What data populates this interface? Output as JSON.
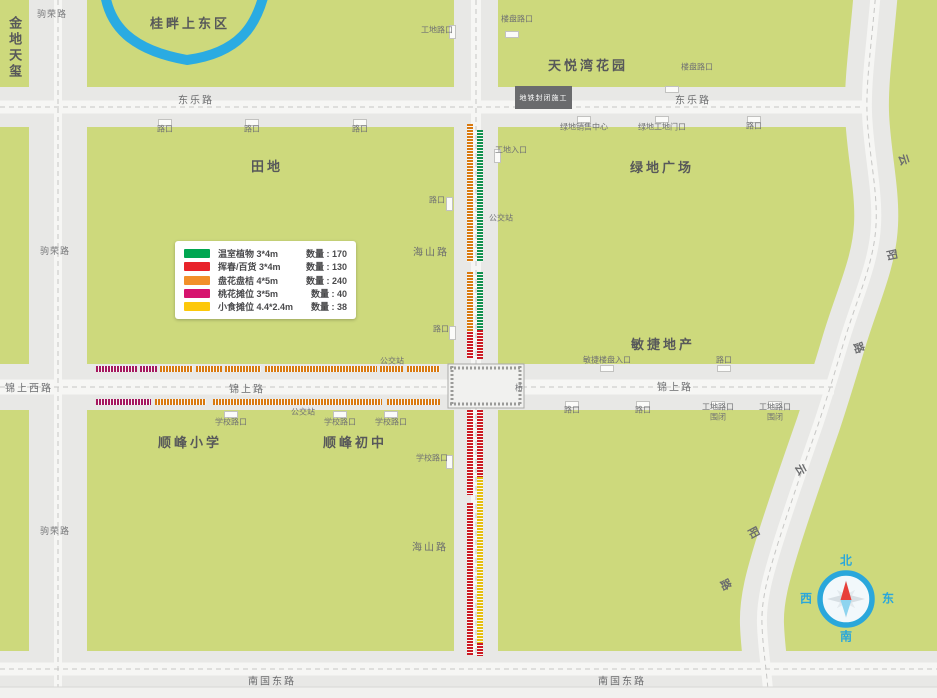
{
  "legend": {
    "rows": [
      {
        "color": "#00a651",
        "name": "温室植物 3*4m",
        "count": "数量 : 170"
      },
      {
        "color": "#e8232a",
        "name": "挥春/百货 3*4m",
        "count": "数量 : 130"
      },
      {
        "color": "#f2902a",
        "name": "盘花盘桔 4*5m",
        "count": "数量 : 240"
      },
      {
        "color": "#d6136e",
        "name": "桃花摊位 3*5m",
        "count": "数量 : 40"
      },
      {
        "color": "#fdc80a",
        "name": "小食摊位 4.4*2.4m",
        "count": "数量 : 38"
      }
    ]
  },
  "compass": {
    "north": "北",
    "south": "南",
    "east": "东",
    "west": "西"
  },
  "construction_sign": "地铁封闭施工",
  "colors": {
    "block_green": "#cdd97c",
    "road_gray": "#e8e8e6",
    "road_core": "#f6f6f4",
    "water_blue": "#2aabe2",
    "compass_blue": "#2aa7db",
    "stall_orange": "#d9790f",
    "stall_red": "#cc1b24",
    "stall_green": "#13914f",
    "stall_magenta": "#a5185f",
    "stall_yellow": "#e6bf0e"
  },
  "map": {
    "area_labels": [
      {
        "text": "金地天玺",
        "x": 14,
        "y": 48,
        "cls": "lbl-area lbl-vert"
      },
      {
        "text": "桂畔上东区",
        "x": 190,
        "y": 24,
        "cls": "lbl-area"
      },
      {
        "text": "天悦湾花园",
        "x": 588,
        "y": 66,
        "cls": "lbl-area"
      },
      {
        "text": "田地",
        "x": 267,
        "y": 167,
        "cls": "lbl-area"
      },
      {
        "text": "绿地广场",
        "x": 662,
        "y": 168,
        "cls": "lbl-area"
      },
      {
        "text": "敏捷地产",
        "x": 663,
        "y": 345,
        "cls": "lbl-area"
      },
      {
        "text": "顺峰小学",
        "x": 190,
        "y": 443,
        "cls": "lbl-area"
      },
      {
        "text": "顺峰初中",
        "x": 355,
        "y": 443,
        "cls": "lbl-area"
      }
    ],
    "road_labels": [
      {
        "text": "驹荣路",
        "x": 52,
        "y": 15,
        "cls": "lbl-road-sm"
      },
      {
        "text": "东乐路",
        "x": 196,
        "y": 101,
        "cls": "lbl-road"
      },
      {
        "text": "东乐路",
        "x": 693,
        "y": 101,
        "cls": "lbl-road"
      },
      {
        "text": "驹荣路",
        "x": 55,
        "y": 252,
        "cls": "lbl-road-sm"
      },
      {
        "text": "海山路",
        "x": 431,
        "y": 253,
        "cls": "lbl-road"
      },
      {
        "text": "锦上西路",
        "x": 29,
        "y": 389,
        "cls": "lbl-road"
      },
      {
        "text": "锦上路",
        "x": 247,
        "y": 390,
        "cls": "lbl-road"
      },
      {
        "text": "锦上路",
        "x": 675,
        "y": 388,
        "cls": "lbl-road"
      },
      {
        "text": "驹荣路",
        "x": 55,
        "y": 532,
        "cls": "lbl-road-sm"
      },
      {
        "text": "海山路",
        "x": 430,
        "y": 548,
        "cls": "lbl-road"
      },
      {
        "text": "南国东路",
        "x": 272,
        "y": 682,
        "cls": "lbl-road"
      },
      {
        "text": "南国东路",
        "x": 622,
        "y": 682,
        "cls": "lbl-road"
      }
    ],
    "char_labels": [
      {
        "text": "云",
        "x": 903,
        "y": 160,
        "rot": 72
      },
      {
        "text": "阳",
        "x": 891,
        "y": 255,
        "rot": 78
      },
      {
        "text": "路",
        "x": 858,
        "y": 348,
        "rot": 70
      },
      {
        "text": "云",
        "x": 800,
        "y": 470,
        "rot": 62
      },
      {
        "text": "阳",
        "x": 753,
        "y": 533,
        "rot": 62
      },
      {
        "text": "路",
        "x": 725,
        "y": 585,
        "rot": 62
      }
    ],
    "small_labels": [
      {
        "text": "工地路口",
        "x": 437,
        "y": 31
      },
      {
        "text": "楼盘路口",
        "x": 517,
        "y": 20
      },
      {
        "text": "楼盘路口",
        "x": 697,
        "y": 68
      },
      {
        "text": "路口",
        "x": 165,
        "y": 130
      },
      {
        "text": "路口",
        "x": 252,
        "y": 130
      },
      {
        "text": "路口",
        "x": 360,
        "y": 130
      },
      {
        "text": "绿地销售中心",
        "x": 584,
        "y": 128
      },
      {
        "text": "绿地工地门口",
        "x": 662,
        "y": 128
      },
      {
        "text": "路口",
        "x": 754,
        "y": 127
      },
      {
        "text": "工地入口",
        "x": 511,
        "y": 151
      },
      {
        "text": "路口",
        "x": 437,
        "y": 201
      },
      {
        "text": "公交站",
        "x": 501,
        "y": 219
      },
      {
        "text": "路口",
        "x": 441,
        "y": 330
      },
      {
        "text": "敏捷楼盘入口",
        "x": 607,
        "y": 361
      },
      {
        "text": "路口",
        "x": 724,
        "y": 361
      },
      {
        "text": "公交站",
        "x": 392,
        "y": 362
      },
      {
        "text": "桥",
        "x": 519,
        "y": 389
      },
      {
        "text": "公交站",
        "x": 303,
        "y": 413
      },
      {
        "text": "路口",
        "x": 572,
        "y": 411
      },
      {
        "text": "路口",
        "x": 643,
        "y": 411
      },
      {
        "text": "工地路口",
        "x": 718,
        "y": 408
      },
      {
        "text": "围闭",
        "x": 718,
        "y": 418
      },
      {
        "text": "工地路口",
        "x": 775,
        "y": 408
      },
      {
        "text": "围闭",
        "x": 775,
        "y": 418
      },
      {
        "text": "学校路口",
        "x": 231,
        "y": 423
      },
      {
        "text": "学校路口",
        "x": 340,
        "y": 423
      },
      {
        "text": "学校路口",
        "x": 391,
        "y": 423
      },
      {
        "text": "学校路口",
        "x": 432,
        "y": 459
      }
    ],
    "stall_strips": {
      "vertical": [
        {
          "x": 467,
          "y": 124,
          "h": 138,
          "c": "orange"
        },
        {
          "x": 467,
          "y": 272,
          "h": 60,
          "c": "orange"
        },
        {
          "x": 467,
          "y": 332,
          "h": 27,
          "c": "red"
        },
        {
          "x": 477,
          "y": 130,
          "h": 132,
          "c": "green"
        },
        {
          "x": 477,
          "y": 272,
          "h": 58,
          "c": "green"
        },
        {
          "x": 477,
          "y": 330,
          "h": 29,
          "c": "red"
        },
        {
          "x": 467,
          "y": 410,
          "h": 85,
          "c": "red"
        },
        {
          "x": 467,
          "y": 503,
          "h": 152,
          "c": "red"
        },
        {
          "x": 477,
          "y": 410,
          "h": 67,
          "c": "red"
        },
        {
          "x": 477,
          "y": 477,
          "h": 166,
          "c": "yellow"
        },
        {
          "x": 477,
          "y": 643,
          "h": 13,
          "c": "red"
        }
      ],
      "horizontal": [
        {
          "x": 96,
          "y": 366,
          "w": 41,
          "c": "magenta"
        },
        {
          "x": 140,
          "y": 366,
          "w": 17,
          "c": "magenta"
        },
        {
          "x": 160,
          "y": 366,
          "w": 33,
          "c": "orange"
        },
        {
          "x": 196,
          "y": 366,
          "w": 26,
          "c": "orange"
        },
        {
          "x": 225,
          "y": 366,
          "w": 36,
          "c": "orange"
        },
        {
          "x": 265,
          "y": 366,
          "w": 112,
          "c": "orange"
        },
        {
          "x": 380,
          "y": 366,
          "w": 23,
          "c": "orange"
        },
        {
          "x": 407,
          "y": 366,
          "w": 33,
          "c": "orange"
        },
        {
          "x": 96,
          "y": 399,
          "w": 55,
          "c": "magenta"
        },
        {
          "x": 155,
          "y": 399,
          "w": 51,
          "c": "orange"
        },
        {
          "x": 213,
          "y": 399,
          "w": 169,
          "c": "orange"
        },
        {
          "x": 387,
          "y": 399,
          "w": 53,
          "c": "orange"
        }
      ]
    },
    "gate_marks": [
      {
        "x": 452,
        "y": 32,
        "o": "v"
      },
      {
        "x": 512,
        "y": 34,
        "o": "h"
      },
      {
        "x": 672,
        "y": 89,
        "o": "h"
      },
      {
        "x": 584,
        "y": 119,
        "o": "h"
      },
      {
        "x": 662,
        "y": 119,
        "o": "h"
      },
      {
        "x": 754,
        "y": 119,
        "o": "h"
      },
      {
        "x": 165,
        "y": 122,
        "o": "h"
      },
      {
        "x": 252,
        "y": 122,
        "o": "h"
      },
      {
        "x": 360,
        "y": 122,
        "o": "h"
      },
      {
        "x": 449,
        "y": 204,
        "o": "v"
      },
      {
        "x": 497,
        "y": 156,
        "o": "v"
      },
      {
        "x": 452,
        "y": 333,
        "o": "v"
      },
      {
        "x": 607,
        "y": 368,
        "o": "h"
      },
      {
        "x": 724,
        "y": 368,
        "o": "h"
      },
      {
        "x": 572,
        "y": 404,
        "o": "h"
      },
      {
        "x": 643,
        "y": 404,
        "o": "h"
      },
      {
        "x": 718,
        "y": 404,
        "o": "h"
      },
      {
        "x": 775,
        "y": 404,
        "o": "h"
      },
      {
        "x": 231,
        "y": 414,
        "o": "h"
      },
      {
        "x": 340,
        "y": 414,
        "o": "h"
      },
      {
        "x": 391,
        "y": 414,
        "o": "h"
      },
      {
        "x": 449,
        "y": 462,
        "o": "v"
      }
    ]
  }
}
